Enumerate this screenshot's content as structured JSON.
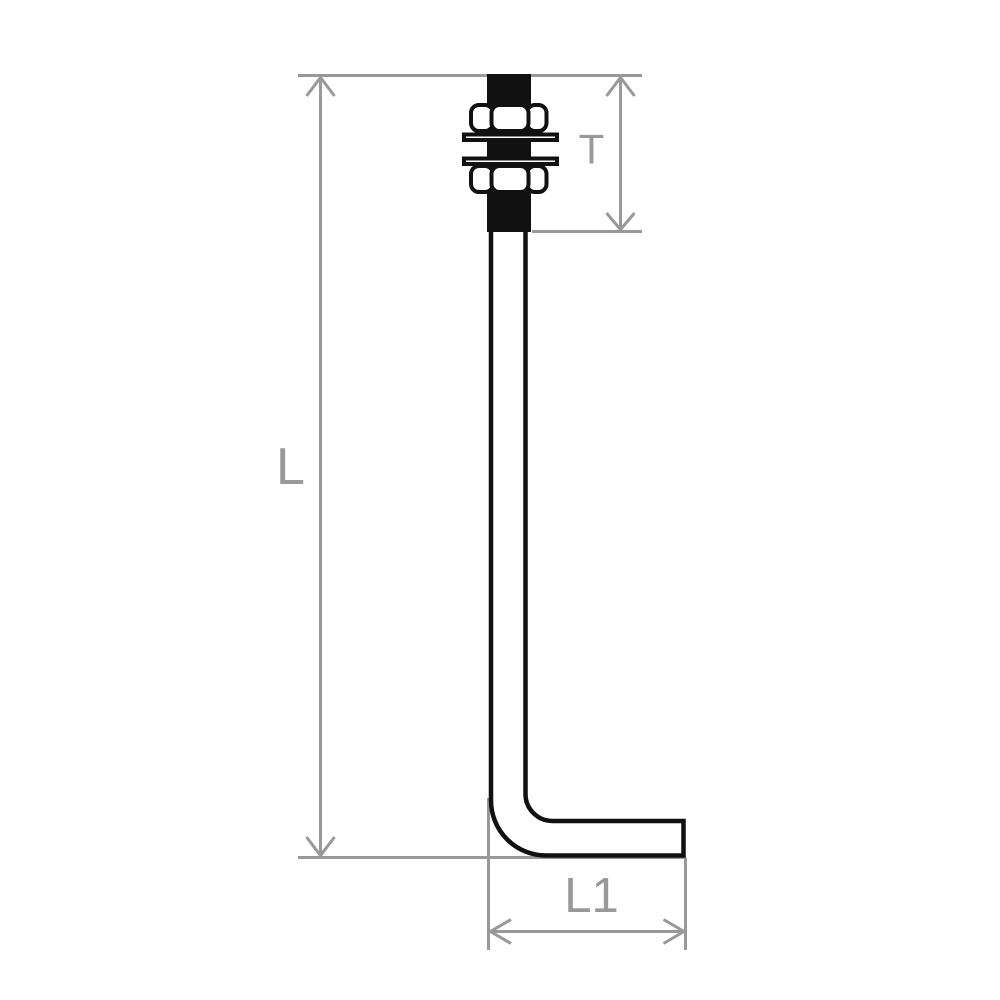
{
  "colors": {
    "dimension_gray": "#999999",
    "bolt_black": "#111111",
    "background": "#ffffff"
  },
  "dimensions": {
    "overall_length": {
      "label": "L"
    },
    "thread_length": {
      "label": "T"
    },
    "leg_length": {
      "label": "L1"
    }
  }
}
